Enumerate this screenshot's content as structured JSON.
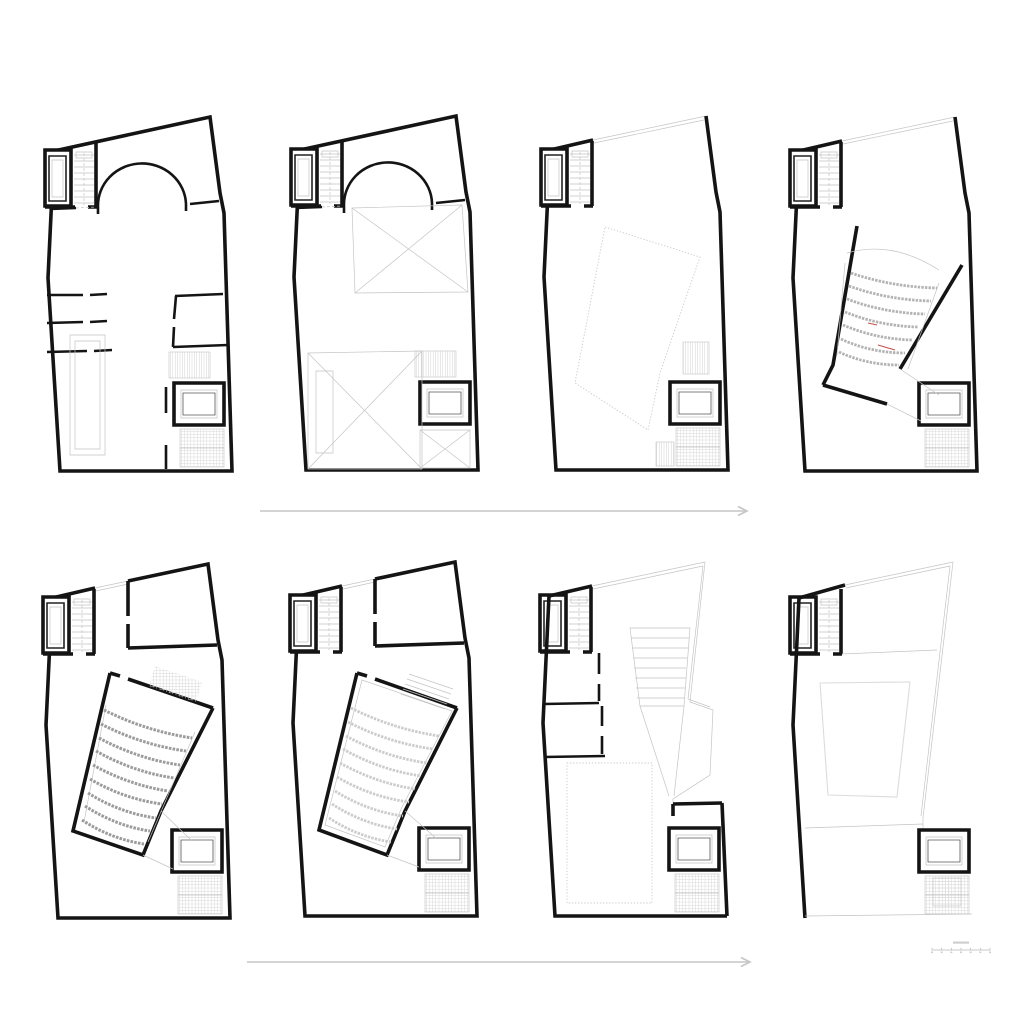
{
  "canvas": {
    "width": 1024,
    "height": 1024,
    "background": "#ffffff"
  },
  "styles": {
    "wall_color": "#141414",
    "light_line_color": "#c4c4c4",
    "seat_row_dark": "#9c9c9c",
    "seat_row_mid": "#b3b3b3",
    "seat_row_light": "#cccccc",
    "red_accent": "#c4524e",
    "arrow_color": "#c6c6c6"
  },
  "shared": {
    "outline": [
      {
        "d": "M12,38 L168,4 L178,80 L182,100 L190,358 L18,358 L6,165 Z",
        "c": "w4",
        "n": "exterior-wall"
      }
    ],
    "outline-roof": [
      {
        "d": "M12,38 L55,28",
        "c": "w4",
        "n": "exterior-wall"
      },
      {
        "d": "M55,28 L168,4 M56,31 L166,8",
        "c": "lt",
        "n": "roof-edge"
      },
      {
        "d": "M168,4 L178,80 L182,100 L190,358 L18,358 L6,165 L12,38",
        "c": "w4",
        "n": "exterior-wall"
      }
    ],
    "outline-upper": [
      {
        "d": "M12,38 L55,28",
        "c": "w4",
        "n": "exterior-wall"
      },
      {
        "d": "M55,28 L88,21 M56,31 L88,24",
        "c": "lt",
        "n": "roof-edge"
      },
      {
        "d": "M88,21 L168,4 L178,80 L182,100 L190,358 L18,358 L6,165 L12,38",
        "c": "w4",
        "n": "exterior-wall"
      }
    ],
    "tl-block": [
      {
        "d": "M3,37 L29,37 L29,93 L3,93 Z",
        "c": "w4f",
        "n": "lift-shaft"
      },
      {
        "d": "M7,43 L24,43 L24,88 L7,88 Z",
        "c": "w2",
        "n": "lift-car"
      },
      {
        "d": "M10,47 L21,47 L21,84 L10,84 Z",
        "c": "lt",
        "n": "lift-car-inner"
      },
      {
        "d": "M32,42 h20 M32,48 h20 M32,54 h20 M32,60 h20 M32,66 h20 M32,72 h20 M32,78 h20 M32,84 h20 M32,90 h20",
        "c": "lt",
        "n": "stair-treads"
      },
      {
        "d": "M34,39 h16 v6 h-16 Z",
        "c": "lt",
        "n": "stair-landing"
      },
      {
        "d": "M42,40 V92",
        "c": "ltd",
        "n": "stair-centerline"
      },
      {
        "d": "M54,29 L54,94",
        "c": "w4",
        "n": "stair-wall"
      },
      {
        "d": "M3,94 L33,94 M46,94 L55,94",
        "c": "w4",
        "n": "block-wall"
      }
    ],
    "arch": [
      {
        "d": "M56,94 A44,42 0 0 1 144,91",
        "c": "w3",
        "n": "arch-wall"
      },
      {
        "d": "M56,94 v7 M144,91 v7",
        "c": "w3",
        "n": "arch-base"
      },
      {
        "d": "M8,96 L34,95",
        "c": "w3",
        "n": "wall"
      },
      {
        "d": "M34,95 L54,94",
        "c": "ltd",
        "n": "door-opening"
      },
      {
        "d": "M148,91 L177,88",
        "c": "w3",
        "n": "wall"
      }
    ],
    "tr-room": [
      {
        "d": "M88,21 L88,56 M88,64 L88,88",
        "c": "w4",
        "n": "room-wall"
      },
      {
        "d": "M88,88 L177,85",
        "c": "w4",
        "n": "room-wall"
      }
    ],
    "lift-room": [
      {
        "d": "M132,270 h50 v42 h-50 Z",
        "c": "w4f",
        "n": "elevator-room"
      },
      {
        "d": "M139,277 h36 v28 h-36 Z",
        "c": "lt",
        "n": "elevator-room-inner"
      },
      {
        "d": "M141,280 h32 v22 h-32 Z",
        "c": "thin",
        "n": "elevator-room-inner"
      }
    ],
    "stair-above-lift": [
      {
        "t": "r",
        "x": 127,
        "y": 239,
        "w": 41,
        "h": 26,
        "c": "hv",
        "n": "stair-hatch"
      }
    ],
    "stair-under-lift": [
      {
        "t": "r",
        "x": 138,
        "y": 316,
        "w": 44,
        "h": 38,
        "c": "hg",
        "n": "stair-hatch"
      },
      {
        "d": "M138,335 h44",
        "c": "lt",
        "n": "stair-midline"
      }
    ]
  },
  "plans": [
    {
      "id": "floor-plan-1",
      "x": 42,
      "y": 113,
      "use": [
        "outline",
        "tl-block",
        "arch",
        "stair-above-lift",
        "lift-room",
        "stair-under-lift"
      ],
      "prims": [
        {
          "d": "M5,182 L41,182 M48,182 L65,181",
          "c": "w3",
          "n": "room-wall"
        },
        {
          "d": "M5,210 L41,209 M48,209 L65,208",
          "c": "w3",
          "n": "room-wall"
        },
        {
          "d": "M5,239 L45,238 M52,238 L70,237",
          "c": "w3",
          "n": "room-wall"
        },
        {
          "d": "M133,183 L181,181",
          "c": "w3",
          "n": "room-wall"
        },
        {
          "d": "M134,183 L132,206 M132,214 L131,234",
          "c": "w3",
          "n": "room-wall"
        },
        {
          "d": "M131,234 L186,232",
          "c": "w3",
          "n": "room-wall"
        },
        {
          "d": "M28,222 h35 v120 h-35 Z",
          "c": "lt",
          "n": "ramp-outline"
        },
        {
          "d": "M33,228 h25 v108 h-25 Z",
          "c": "lt",
          "n": "ramp-inner"
        },
        {
          "d": "M124,274 L124,300 M124,332 L124,356",
          "c": "w3",
          "n": "wall"
        }
      ]
    },
    {
      "id": "floor-plan-2",
      "x": 288,
      "y": 112,
      "use": [
        "outline",
        "tl-block",
        "arch",
        "stair-above-lift",
        "lift-room"
      ],
      "prims": [
        {
          "d": "M64,96 L174,93 L180,180 L67,181 Z",
          "c": "lt",
          "n": "void-outline"
        },
        {
          "d": "M64,96 L180,180 M174,93 L67,181",
          "c": "lt",
          "n": "void-cross"
        },
        {
          "d": "M20,241 L134,239 L134,357 L20,357 Z",
          "c": "lt",
          "n": "void-outline"
        },
        {
          "d": "M20,241 L134,357 M134,239 L20,357",
          "c": "lt",
          "n": "void-cross"
        },
        {
          "d": "M28,259 h17 v82 h-17 Z",
          "c": "lt",
          "n": "ramp-inner"
        },
        {
          "d": "M132,318 h50 v38 h-50 Z",
          "c": "lt",
          "n": "void-outline"
        },
        {
          "d": "M132,318 L182,356 M182,318 L132,356",
          "c": "lt",
          "n": "void-cross"
        }
      ]
    },
    {
      "id": "floor-plan-3",
      "x": 538,
      "y": 112,
      "use": [
        "outline-roof",
        "tl-block",
        "lift-room",
        "stair-under-lift"
      ],
      "prims": [
        {
          "d": "M67,115 L162,145 L122,261 L110,318 L37,271 Z",
          "c": "dot",
          "n": "auditorium-dashed-outline"
        },
        {
          "t": "r",
          "x": 145,
          "y": 230,
          "w": 26,
          "h": 32,
          "c": "hv",
          "n": "stair-hatch"
        },
        {
          "t": "r",
          "x": 118,
          "y": 330,
          "w": 18,
          "h": 24,
          "c": "hv",
          "n": "stair-hatch"
        }
      ]
    },
    {
      "id": "floor-plan-4",
      "x": 787,
      "y": 113,
      "use": [
        "outline-roof",
        "tl-block",
        "lift-room",
        "stair-under-lift"
      ],
      "prims": [
        {
          "d": "M70,113 L46,252 L36,272",
          "c": "w4",
          "n": "auditorium-wall"
        },
        {
          "d": "M36,272 L100,291",
          "c": "w4",
          "n": "auditorium-wall"
        },
        {
          "d": "M175,152 L113,256",
          "c": "w4",
          "n": "auditorium-wall"
        },
        {
          "d": "M60,140 Q105,127 152,157",
          "c": "lt",
          "n": "balcony-edge"
        },
        {
          "d": "M58,150 L50,242 M152,170 L121,256",
          "c": "lt",
          "n": "aisle-edge"
        },
        {
          "d": "M64,160 Q105,174 150,175 M62,173 Q101,187 144,188 M60,186 Q97,200 138,201 M58,199 Q93,213 131,214 M56,212 Q89,226 125,227 M54,226 Q84,240 118,240 M52,239 Q80,252 112,252",
          "c": "seatm",
          "n": "auditorium-seating"
        },
        {
          "d": "M81,210 l9,2",
          "c": "red",
          "n": "red-mark"
        },
        {
          "d": "M91,232 l17,5",
          "c": "red",
          "n": "red-mark"
        },
        {
          "d": "M100,291 L134,308 M113,256 L152,282",
          "c": "lt",
          "n": "connector-line"
        }
      ]
    },
    {
      "id": "floor-plan-5",
      "x": 40,
      "y": 560,
      "use": [
        "outline-upper",
        "tl-block",
        "tr-room",
        "lift-room",
        "stair-under-lift"
      ],
      "prims": [
        {
          "d": "M70,113 L80,116 M88,119 L173,148",
          "c": "w4",
          "n": "auditorium-wall"
        },
        {
          "d": "M173,148 L121,251 L103,295 L33,271 L70,113",
          "c": "w4",
          "n": "auditorium-wall"
        },
        {
          "d": "M115,106 L162,122 L156,142 L109,126 Z",
          "c": "hgf",
          "n": "stage-hatch"
        },
        {
          "d": "M66,145 L44,262 M155,172 L108,282",
          "c": "lt",
          "n": "aisle-edge"
        },
        {
          "d": "M64,150 Q106,171 152,178 M61,164 Q102,185 146,191 M59,178 Q98,199 140,205 M56,191 Q93,212 134,218 M53,205 Q89,225 128,231 M50,219 Q84,239 122,244 M48,233 Q80,253 116,258 M45,246 Q76,266 110,271 M42,260 Q71,279 104,284",
          "c": "seatd",
          "n": "auditorium-seating"
        },
        {
          "d": "M103,295 L133,309 M121,251 L152,281",
          "c": "lt",
          "n": "connector-line"
        }
      ]
    },
    {
      "id": "floor-plan-6",
      "x": 287,
      "y": 558,
      "use": [
        "outline-upper",
        "tl-block",
        "tr-room",
        "lift-room",
        "stair-under-lift"
      ],
      "prims": [
        {
          "d": "M70,115 L80,118 M88,121 L170,150",
          "c": "w4",
          "n": "auditorium-wall"
        },
        {
          "d": "M170,150 L118,253 L100,297 L32,272 L70,115",
          "c": "w4",
          "n": "auditorium-wall"
        },
        {
          "d": "M75,122 L165,153 L115,249 L98,289 L38,267 Z",
          "c": "lt",
          "n": "auditorium-floor"
        },
        {
          "d": "M122,116 L166,131 M120,121 L164,136 M118,126 L162,141 M116,131 L160,146 M114,136 L158,151",
          "c": "lt",
          "n": "stair-treads"
        },
        {
          "d": "M64,150 Q106,171 152,178 M61,164 Q102,185 146,191 M59,178 Q98,199 140,205 M56,191 Q93,212 134,218 M53,205 Q89,225 128,231 M50,219 Q84,239 122,244 M48,233 Q80,253 116,258 M45,246 Q76,266 110,271 M42,260 Q71,279 104,284",
          "c": "seatl",
          "n": "auditorium-seating"
        },
        {
          "d": "M100,297 L132,309 M118,253 L150,281",
          "c": "lt",
          "n": "connector-line"
        }
      ]
    },
    {
      "id": "floor-plan-7",
      "x": 537,
      "y": 558,
      "use": [
        "tl-block",
        "lift-room",
        "stair-under-lift"
      ],
      "prims": [
        {
          "d": "M12,38 L6,165 L18,358 L190,358",
          "c": "w4",
          "n": "exterior-wall"
        },
        {
          "d": "M185,245 L190,358",
          "c": "w4",
          "n": "exterior-wall"
        },
        {
          "d": "M12,38 L55,28",
          "c": "w4",
          "n": "exterior-wall"
        },
        {
          "d": "M55,28 L168,4 M56,31 L166,8",
          "c": "lt",
          "n": "roof-edge"
        },
        {
          "d": "M168,4 L153,144 L176,152 L173,217 L136,241 L136,256",
          "c": "lt",
          "n": "roof-edge-zigzag"
        },
        {
          "d": "M166,8 L151,141 L173,149",
          "c": "lt",
          "n": "roof-edge-inner"
        },
        {
          "d": "M62,95 L62,116 M62,126 L62,143",
          "c": "w3",
          "n": "room-wall"
        },
        {
          "d": "M7,146 L62,145",
          "c": "w3",
          "n": "room-wall"
        },
        {
          "d": "M65,148 L65,168 M65,178 L65,196",
          "c": "w3",
          "n": "room-wall"
        },
        {
          "d": "M7,199 L68,198",
          "c": "w3",
          "n": "room-wall"
        },
        {
          "d": "M93,70 L153,70 L147,148 L103,148 Z",
          "c": "lt",
          "n": "terrace-steps"
        },
        {
          "d": "M94,80 L152,80 M95,90 L151,90 M96,100 L150,100 M97,110 L149,110 M98,120 L149,120 M99,130 L148,130 M100,140 L148,140",
          "c": "lt",
          "n": "terrace-step-lines"
        },
        {
          "d": "M103,148 L132,238 M147,148 L137,238",
          "c": "lt",
          "n": "connector-line"
        },
        {
          "d": "M30,205 h85 v140 h-85 Z",
          "c": "dot",
          "n": "room-below-dashed"
        },
        {
          "d": "M136,246 L185,245 M136,246 L136,258",
          "c": "w4",
          "n": "wall"
        }
      ]
    },
    {
      "id": "floor-plan-8",
      "x": 787,
      "y": 560,
      "use": [
        "tl-block",
        "lift-room",
        "stair-under-lift"
      ],
      "prims": [
        {
          "d": "M12,38 L6,165 L18,358",
          "c": "w4",
          "n": "exterior-wall"
        },
        {
          "d": "M12,38 L58,25",
          "c": "w4",
          "n": "exterior-wall"
        },
        {
          "d": "M58,25 L166,2 M59,28 L163,6",
          "c": "lt",
          "n": "roof-edge"
        },
        {
          "d": "M166,2 L136,258 M163,6 L134,256",
          "c": "lt",
          "n": "roof-edge"
        },
        {
          "d": "M136,258 L136,268",
          "c": "lt",
          "n": "roof-edge"
        },
        {
          "d": "M55,94 L150,90",
          "c": "lt",
          "n": "floor-line"
        },
        {
          "d": "M18,268 L136,264",
          "c": "lt",
          "n": "floor-line"
        },
        {
          "d": "M18,356 L185,354",
          "c": "lt",
          "n": "floor-line"
        },
        {
          "d": "M33,123 L123,122 L110,237 L41,235 Z",
          "c": "lt2",
          "n": "skylight-outline"
        },
        {
          "t": "r",
          "x": 146,
          "y": 318,
          "w": 28,
          "h": 28,
          "c": "hg",
          "n": "stair-hatch"
        }
      ]
    }
  ],
  "arrows": [
    {
      "x": 260,
      "y": 511,
      "length": 487,
      "direction": "right"
    },
    {
      "x": 247,
      "y": 962,
      "length": 503,
      "direction": "right"
    }
  ],
  "scale_bar": {
    "x": 932,
    "y": 950,
    "width": 58,
    "tick_count": 7
  }
}
